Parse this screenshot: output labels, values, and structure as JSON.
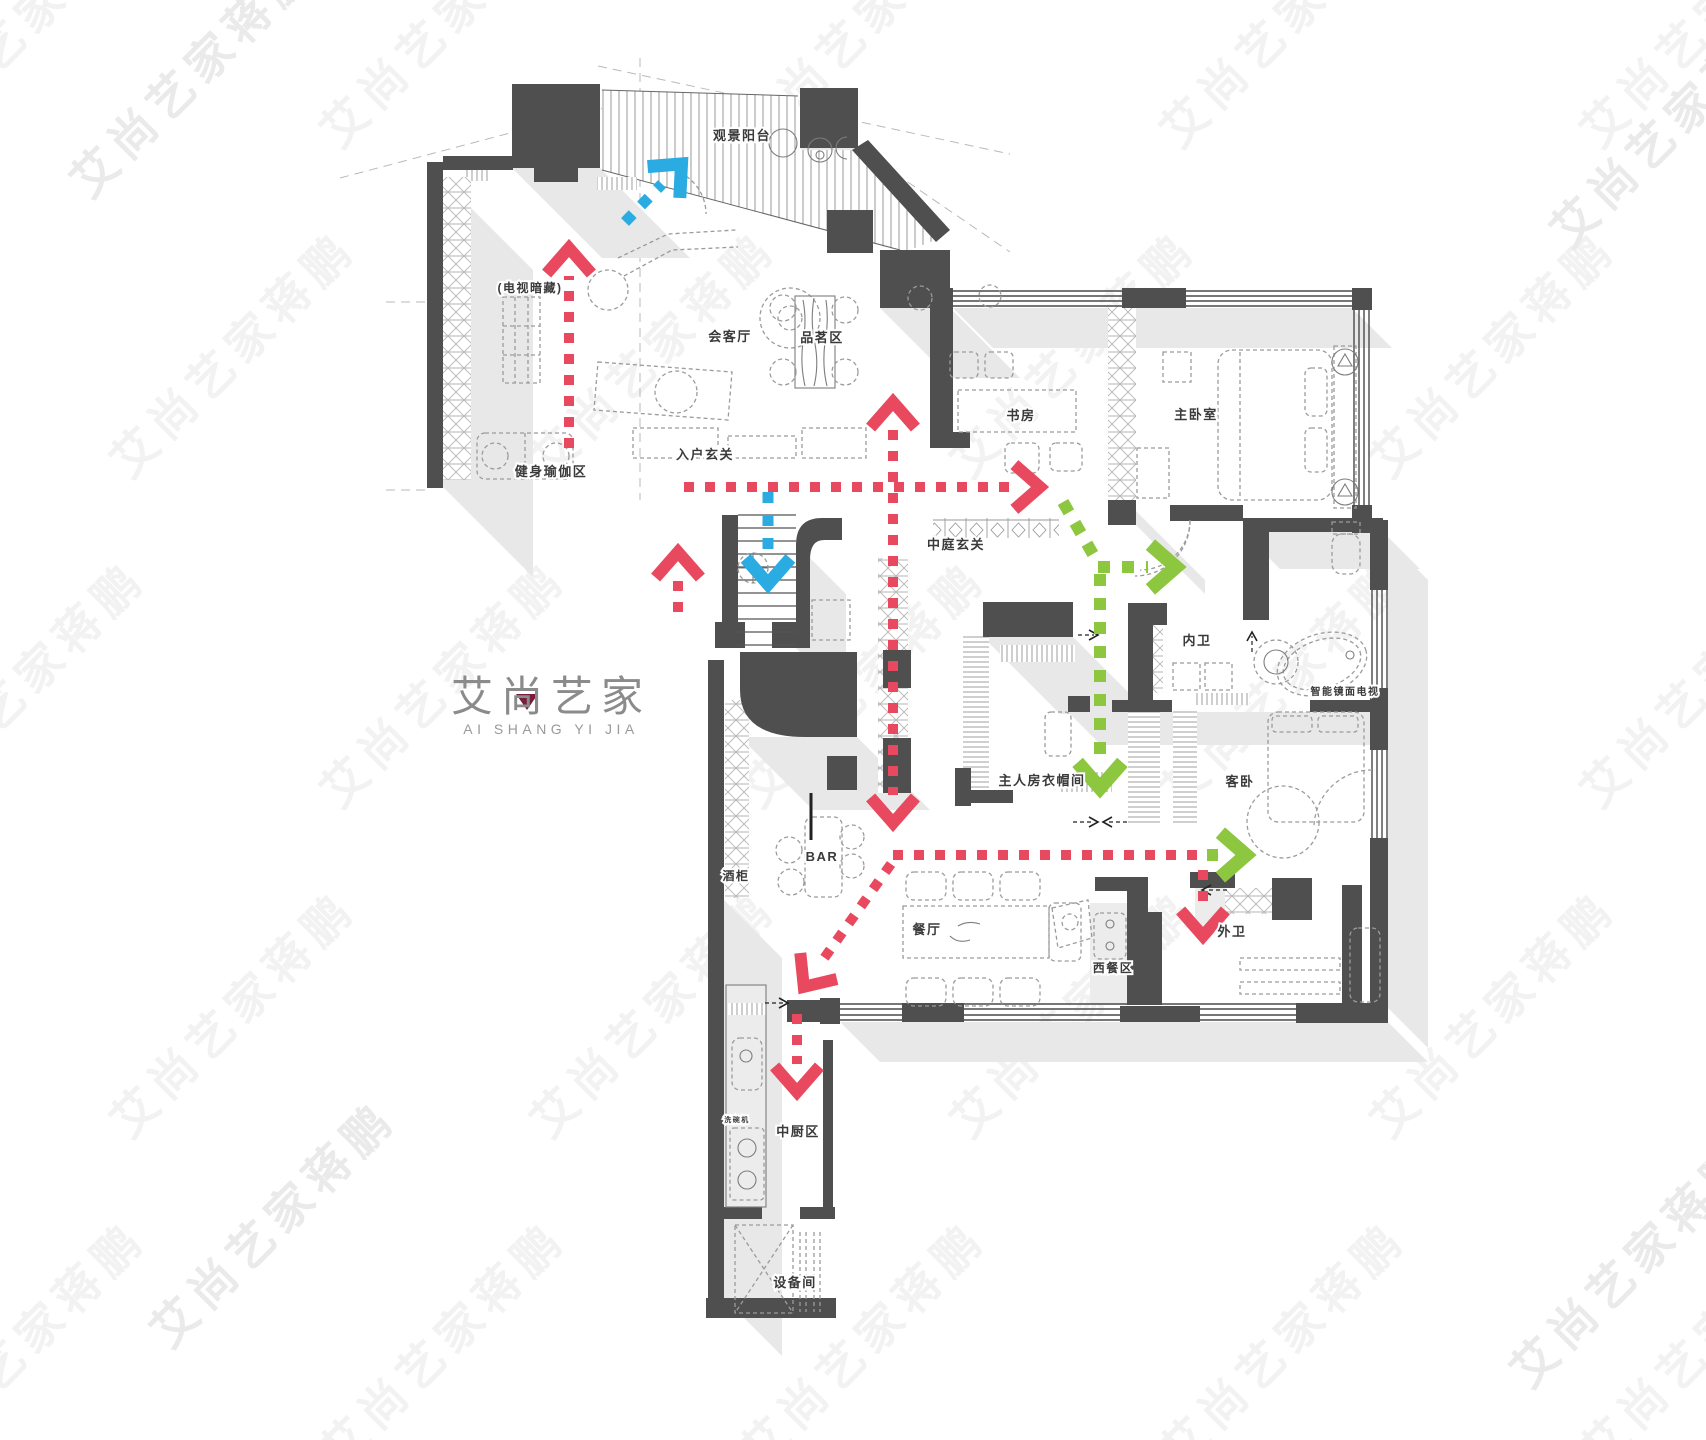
{
  "page": {
    "background": "#ffffff",
    "width": 1706,
    "height": 1440
  },
  "colors": {
    "page": "#ffffff",
    "wall": "#4f4f4f",
    "shadow": "#e8e8e8",
    "tint": "#ececec",
    "furn": "#9b9b9b",
    "label": "#3a3a3a",
    "red": "#e8495e",
    "blue": "#2aabe2",
    "green": "#8dc63f",
    "wm": "#f2f2f2",
    "wmdark": "#eaeaea",
    "logogray": "#8b8b8b",
    "logored": "#7a1d3a"
  },
  "logo": {
    "title": "艾尚艺家",
    "subtitle": "AI SHANG YI JIA"
  },
  "watermark": {
    "text": "艾尚艺家蒋鹏"
  },
  "rooms": [
    {
      "id": "view-balcony",
      "label": "观景阳台",
      "x": 742,
      "y": 140,
      "size": 13
    },
    {
      "id": "tv-hidden",
      "label": "(电视暗藏)",
      "x": 530,
      "y": 292,
      "size": 12
    },
    {
      "id": "reception",
      "label": "会客厅",
      "x": 730,
      "y": 341,
      "size": 13
    },
    {
      "id": "tea-area",
      "label": "品茗区",
      "x": 822,
      "y": 342,
      "size": 13
    },
    {
      "id": "entry-foyer",
      "label": "入户玄关",
      "x": 705,
      "y": 459,
      "size": 13
    },
    {
      "id": "gym-yoga",
      "label": "健身瑜伽区",
      "x": 551,
      "y": 476,
      "size": 13
    },
    {
      "id": "study",
      "label": "书房",
      "x": 1021,
      "y": 420,
      "size": 13
    },
    {
      "id": "master-bedroom",
      "label": "主卧室",
      "x": 1196,
      "y": 419,
      "size": 13
    },
    {
      "id": "atrium-foyer",
      "label": "中庭玄关",
      "x": 956,
      "y": 549,
      "size": 13
    },
    {
      "id": "inner-bath",
      "label": "内卫",
      "x": 1197,
      "y": 645,
      "size": 13
    },
    {
      "id": "mirror-tv",
      "label": "智能镜面电视",
      "x": 1345,
      "y": 695,
      "size": 10
    },
    {
      "id": "master-closet",
      "label": "主人房衣帽间",
      "x": 1042,
      "y": 785,
      "size": 13
    },
    {
      "id": "guest-bedroom",
      "label": "客卧",
      "x": 1240,
      "y": 786,
      "size": 13
    },
    {
      "id": "wine-cabinet",
      "label": "酒柜",
      "x": 736,
      "y": 880,
      "size": 12
    },
    {
      "id": "bar",
      "label": "BAR",
      "x": 822,
      "y": 861,
      "size": 13
    },
    {
      "id": "dining",
      "label": "餐厅",
      "x": 927,
      "y": 934,
      "size": 13
    },
    {
      "id": "western-dining",
      "label": "西餐区",
      "x": 1113,
      "y": 972,
      "size": 12
    },
    {
      "id": "outer-bath",
      "label": "外卫",
      "x": 1232,
      "y": 936,
      "size": 13
    },
    {
      "id": "chinese-kitchen",
      "label": "中厨区",
      "x": 798,
      "y": 1136,
      "size": 13
    },
    {
      "id": "equipment-room",
      "label": "设备间",
      "x": 795,
      "y": 1287,
      "size": 13
    },
    {
      "id": "dishwasher",
      "label": "洗碗机",
      "x": 737,
      "y": 1122,
      "size": 7
    }
  ],
  "flow_paths": [
    {
      "id": "red-gym-up",
      "color": "red",
      "points": [
        [
          569,
          448
        ],
        [
          569,
          276
        ]
      ],
      "head": "end"
    },
    {
      "id": "red-stairs-side-up",
      "color": "red",
      "points": [
        [
          678,
          612
        ],
        [
          678,
          580
        ]
      ],
      "head": "end"
    },
    {
      "id": "red-to-study",
      "color": "red",
      "points": [
        [
          684,
          487
        ],
        [
          1012,
          487
        ]
      ],
      "head": "end"
    },
    {
      "id": "red-center-vert",
      "color": "red",
      "points": [
        [
          893,
          430
        ],
        [
          893,
          795
        ]
      ],
      "head": "both"
    },
    {
      "id": "red-long-horiz",
      "color": "red",
      "points": [
        [
          893,
          855
        ],
        [
          1207,
          855
        ]
      ],
      "head": "none"
    },
    {
      "id": "green-horiz-end",
      "color": "green",
      "points": [
        [
          1207,
          855
        ],
        [
          1218,
          855
        ]
      ],
      "head": "end"
    },
    {
      "id": "red-diag-kitchen",
      "color": "red",
      "points": [
        [
          891,
          864
        ],
        [
          820,
          964
        ]
      ],
      "head": "end"
    },
    {
      "id": "red-kitchen-down",
      "color": "red",
      "points": [
        [
          797,
          1014
        ],
        [
          797,
          1064
        ]
      ],
      "head": "end"
    },
    {
      "id": "red-outerbath-down",
      "color": "red",
      "points": [
        [
          1203,
          870
        ],
        [
          1203,
          908
        ]
      ],
      "head": "end"
    },
    {
      "id": "blue-balcony",
      "color": "blue",
      "points": [
        [
          625,
          222
        ],
        [
          662,
          184
        ]
      ],
      "head": "end"
    },
    {
      "id": "blue-stairs-down",
      "color": "blue",
      "points": [
        [
          768,
          492
        ],
        [
          768,
          556
        ]
      ],
      "head": "end"
    },
    {
      "id": "green-diag",
      "color": "green",
      "points": [
        [
          1063,
          502
        ],
        [
          1094,
          556
        ]
      ],
      "head": "none"
    },
    {
      "id": "green-right",
      "color": "green",
      "points": [
        [
          1098,
          567
        ],
        [
          1148,
          567
        ]
      ],
      "head": "end"
    },
    {
      "id": "green-down",
      "color": "green",
      "points": [
        [
          1100,
          574
        ],
        [
          1100,
          760
        ]
      ],
      "head": "end"
    }
  ]
}
